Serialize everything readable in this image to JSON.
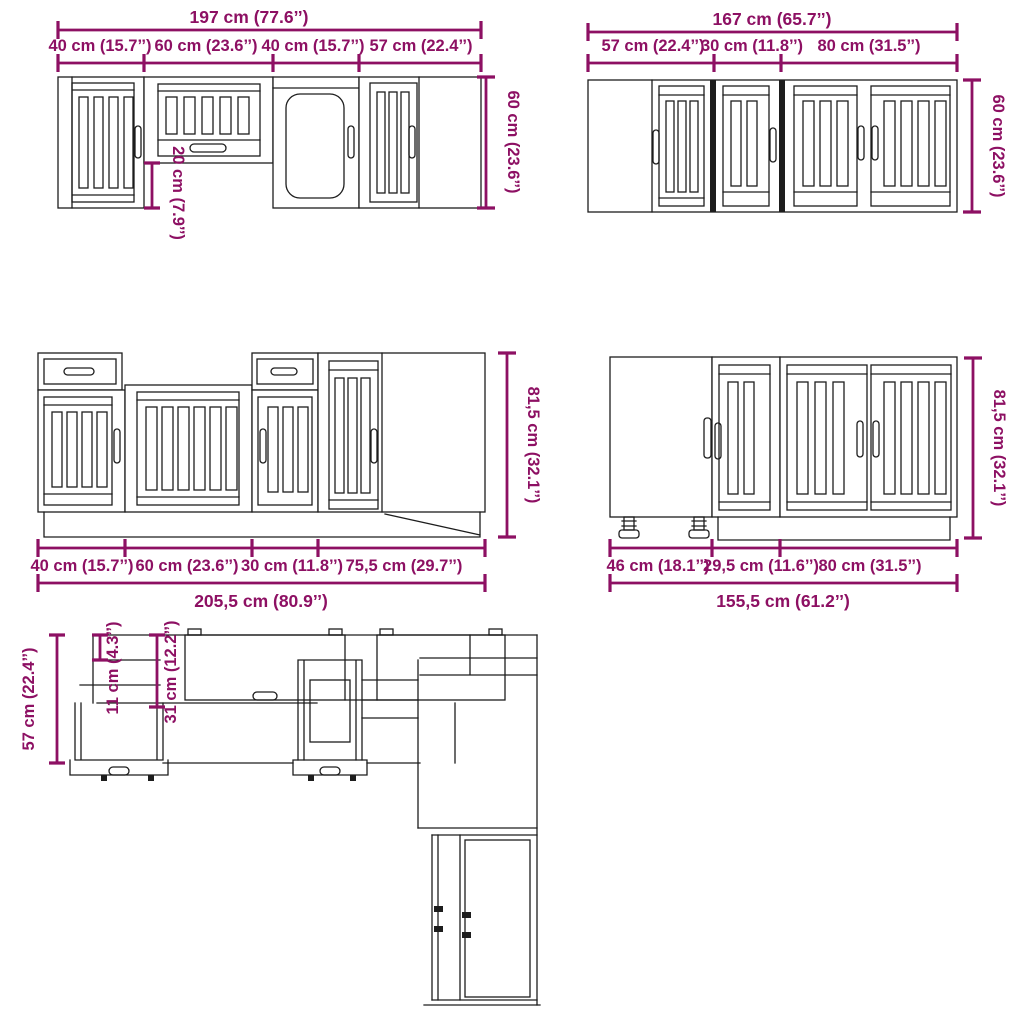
{
  "diagram": {
    "accent_color": "#8d1063",
    "line_color": "#1d1d1d",
    "wall_cabinets_left": {
      "total": "197 cm (77.6’’)",
      "sections": [
        "40 cm (15.7’’)",
        "60 cm (23.6’’)",
        "40 cm (15.7’’)",
        "57 cm (22.4’’)"
      ],
      "height": "60 cm (23.6’’)",
      "middle_cabinet_height": "20 cm (7.9’’)"
    },
    "wall_cabinets_right": {
      "total": "167 cm (65.7’’)",
      "sections": [
        "57 cm (22.4’’)",
        "30 cm (11.8’’)",
        "80 cm (31.5’’)"
      ],
      "height": "60 cm (23.6’’)"
    },
    "base_cabinets_left": {
      "total": "205,5 cm (80.9’’)",
      "sections": [
        "40 cm (15.7’’)",
        "60 cm (23.6’’)",
        "30 cm (11.8’’)",
        "75,5 cm (29.7’’)"
      ],
      "height": "81,5 cm (32.1’’)"
    },
    "base_cabinets_right": {
      "total": "155,5 cm (61.2’’)",
      "sections": [
        "46 cm (18.1’’)",
        "29,5 cm (11.6’’)",
        "80 cm (31.5’’)"
      ],
      "height": "81,5 cm (32.1’’)"
    },
    "plan_view": {
      "depth": "57 cm (22.4’’)",
      "upper_depth": "11 cm (4.3’’)",
      "lower_depth": "31 cm (12.2’’)"
    }
  }
}
